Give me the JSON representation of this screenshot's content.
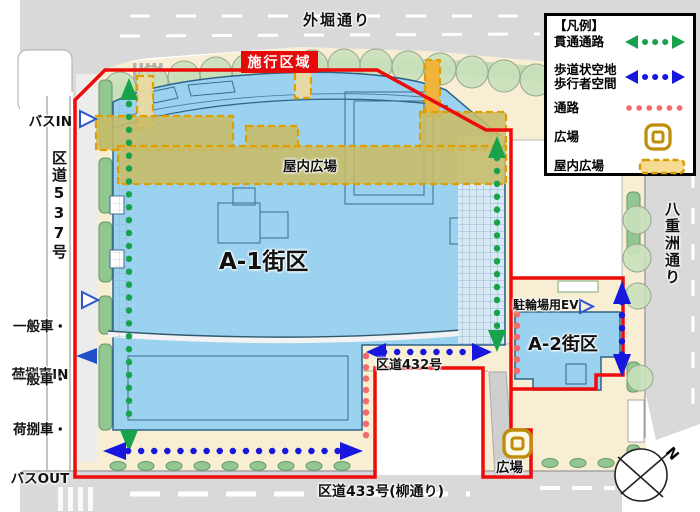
{
  "map": {
    "streets": {
      "sotobori_dori": "外堀通り",
      "yaesu_dori": "八重洲通り",
      "kudo_537": "区道537号",
      "kudo_432": "区道432号",
      "kudo_433": "区道433号(柳通り)"
    },
    "blocks": {
      "a1": "A-1街区",
      "a2": "A-2街区"
    },
    "labels": {
      "indoor_plaza": "屋内広場",
      "plaza": "広場",
      "boundary": "施行区域",
      "bicycle_ev": "駐輪場用EV",
      "compass_north": "N"
    },
    "access": {
      "bus_in": "バスIN",
      "in_line1": "一般車・",
      "in_line2": "荷捌車IN",
      "out_line1": "一般車・",
      "out_line2": "荷捌車・",
      "out_line3": "バスOUT"
    }
  },
  "legend": {
    "title": "【凡例】",
    "through_passage": "貫通通路",
    "pedestrian_line1": "歩道状空地",
    "pedestrian_line2": "歩行者空間",
    "passage": "通路",
    "plaza": "広場",
    "indoor_plaza": "屋内広場"
  },
  "colors": {
    "boundary_red": "#ee0b0b",
    "through_green": "#17a24b",
    "pedestrian_blue": "#1717dd",
    "passage_pink": "#f36b6b",
    "plaza_gold": "#bf8e08",
    "indoor_khaki": "#c8bc66",
    "building_blue": "#9bd2ef"
  }
}
